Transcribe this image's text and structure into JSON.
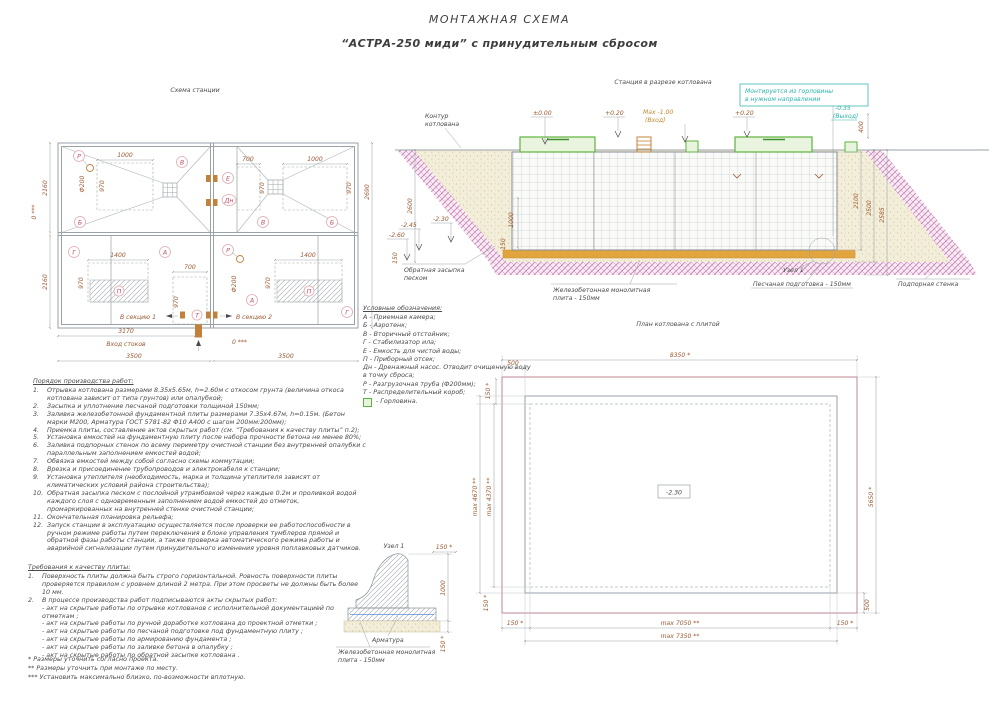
{
  "titles": {
    "main": "МОНТАЖНАЯ СХЕМА",
    "sub": "“АСТРА-250 миди” с принудительным сбросом"
  },
  "plan": {
    "title": "Схема станции",
    "dims": {
      "w1000": "1000",
      "w700": "700",
      "w1400": "1400",
      "h970": "970",
      "h2160": "2160",
      "w2690": "2690",
      "w3170": "3170",
      "w3500": "3500",
      "zero3": "0 ***",
      "dia200": "Ф200"
    },
    "labels": {
      "P": "Р",
      "V": "В",
      "B": "Б",
      "E": "Е",
      "Dn": "Дн",
      "G": "Г",
      "A": "А",
      "Pp": "П",
      "T": "Т"
    },
    "notes": {
      "inlet": "Вход стоков",
      "sec1": "В секцию 1",
      "sec2": "В секцию 2"
    }
  },
  "section": {
    "title": "Станция в разрезе котлована",
    "labels": {
      "contour1": "Контур",
      "contour2": "котлована",
      "note1": "Монтируется из горловины",
      "note2": "в нужном направлении",
      "backfill1": "Обратная засыпка",
      "backfill2": "песком",
      "slab1": "Железобетонная монолитная",
      "slab2": "плита - 150мм",
      "node": "Узел 1",
      "sand": "Песчаная подготовка - 150мм",
      "wall": "Подпорная стенка"
    },
    "marks": {
      "zero": "±0.00",
      "p020": "+0.20",
      "max1": "Max -1.00",
      "max2": "(Вход)",
      "out1": "-0.35",
      "out2": "(Выход)",
      "m230": "-2.30",
      "m245": "-2.45",
      "m260": "-2.60"
    },
    "dims": {
      "d400": "400",
      "d2600": "2600",
      "d2100": "2100",
      "d2500": "2500",
      "d2585": "2585",
      "d150": "150",
      "d1000": "1000"
    }
  },
  "legend": {
    "title": "Условные обозначения:",
    "items": [
      "А  -  Приемная камера;",
      "Б  -  Аэротенк;",
      "В  -  Вторичный отстойник;",
      "Г  -  Стабилизатор ила;",
      "Е  -  Емкость для чистой воды;",
      "П  -  Приборный отсек;",
      "Дн -  Дренажный насос. Отводит очищенную воду в точку сброса;",
      "Р  -  Разгрузочная труба (Ф200мм);",
      "Т  -  Распределительный короб;"
    ],
    "neck": "-  Горловина."
  },
  "work_order": {
    "title": "Порядок производства работ:",
    "items": [
      {
        "n": "1.",
        "t": "Отрывка котлована размерами 8.35х5.65м, h=2.60м с откосом грунта (величина откоса котлована зависит от типа грунтов) или опалубкой;"
      },
      {
        "n": "2.",
        "t": "Засыпка и уплотнение песчаной подготовки толщиной 150мм;"
      },
      {
        "n": "3.",
        "t": "Заливка железобетонной фундаментной плиты размерами 7.35х4.67м, h=0.15м. (Бетон марки М200, Арматура ГОСТ 5781-82 Ф10 А400 с шагом 200мм:200мм);"
      },
      {
        "n": "4.",
        "t": "Приемка плиты, составление актов скрытых работ (см. “Требования к качеству плиты” п.2);"
      },
      {
        "n": "5.",
        "t": "Установка емкостей на фундаментную плиту после набора прочности бетона не менее 80%;"
      },
      {
        "n": "6.",
        "t": "Заливка подпорных стенок по всему периметру очистной станции без внутренней опалубки с параллельным заполнением емкостей водой;"
      },
      {
        "n": "7.",
        "t": "Обвязка емкостей между собой согласно схемы коммутации;"
      },
      {
        "n": "8.",
        "t": "Врезка и присоединение трубопроводов и электрокабеля к станции;"
      },
      {
        "n": "9.",
        "t": "Установка утеплителя (необходимость, марка и толщина утеплителя зависят от климатических условий района строительства);"
      },
      {
        "n": "10.",
        "t": "Обратная засыпка песком с послойной утрамбовкой через каждые 0.2м и проливкой водой каждого слоя с одновременным заполнением водой емкостей до отметок, промаркированных на внутренней стенке очистной станции;"
      },
      {
        "n": "11.",
        "t": "Окончательная планировка рельефа;"
      },
      {
        "n": "12.",
        "t": "Запуск станции в эксплуатацию осуществляется после проверки ее работоспособности в ручном режиме работы путем переключения в блоке управления тумблеров прямой и обратной фазы работы станции, а также проверка автоматического режима работы и аварийной сигнализации путем принудительного изменения уровня поплавковых датчиков."
      }
    ]
  },
  "requirements": {
    "title": "Требования к качеству плиты:",
    "items": [
      {
        "n": "1.",
        "t": "Поверхность плиты должна быть строго горизонтальной. Ровность поверхности плиты проверяется правилом с уровнем длиной 2 метра. При этом просветы не должны быть  более 10 мм."
      },
      {
        "n": "2.",
        "t": "В процессе производства работ подписываются акты скрытых работ:"
      }
    ],
    "acts": [
      "- акт на скрытые работы по отрывке котлованов с исполнительной документацией по отметкам ;",
      "- акт на скрытые работы по ручной доработке котлована до проектной отметки ;",
      "- акт на скрытые работы по песчаной подготовке под фундаментную плиту ;",
      "- акт на скрытые работы по армированию фундамента ;",
      "- акт на скрытые работы по заливке бетона в опалубку ;",
      "- акт на скрытые работы по обратной засыпке котлована ."
    ]
  },
  "footnotes": [
    "*  Размеры уточнить согласно проекта.",
    "**  Размеры уточнить при монтаже по месту.",
    "***  Установить максимально близко, по-возможности вплотную."
  ],
  "pit_plan": {
    "title": "План котлована с плитой",
    "elevation": "-2.30",
    "dims": {
      "d8350": "8350 *",
      "d500": "500",
      "d150": "150 *",
      "d4670": "max 4670 **",
      "d4370": "max 4370 **",
      "d5650": "5650 *",
      "d7050": "max 7050 **",
      "d7350": "max 7350 **"
    }
  },
  "node_detail": {
    "title": "Узел 1",
    "dims": {
      "d150": "150 *",
      "d1000": "1000"
    },
    "labels": {
      "rebar": "Арматура",
      "slab1": "Железобетонная монолитная",
      "slab2": "плита - 150мм"
    }
  }
}
